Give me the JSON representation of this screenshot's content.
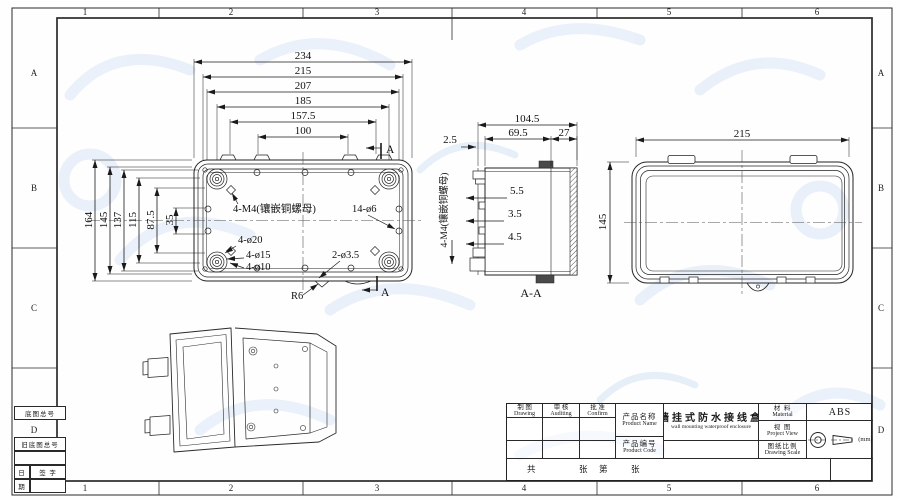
{
  "sheet": {
    "grid_cols": [
      "1",
      "2",
      "3",
      "4",
      "5",
      "6"
    ],
    "grid_rows": [
      "A",
      "B",
      "C",
      "D"
    ]
  },
  "margin_block": {
    "base_no": "底图总号",
    "old_base_no": "旧底图总号",
    "date_top": "日",
    "date_bottom": "期",
    "signature": "签  字"
  },
  "views": {
    "back": {
      "h_dims": [
        "234",
        "215",
        "207",
        "185",
        "157.5",
        "100"
      ],
      "v_dims": [
        "164",
        "145",
        "137",
        "115",
        "87.5",
        "35"
      ],
      "ann_insert": "4-M4(镶嵌铜螺母)",
      "ann_holes": "14-ø6",
      "ann_d20": "4-ø20",
      "ann_d15": "4-ø15",
      "ann_d10": "4-ø10",
      "ann_d35": "2-ø3.5",
      "ann_r6": "R6",
      "section_letter": "A"
    },
    "section": {
      "label": "A-A",
      "dim_total": "104.5",
      "dim_left": "69.5",
      "dim_right": "27",
      "dim_flange": "2.5",
      "dim_s1": "5.5",
      "dim_s2": "3.5",
      "dim_s3": "4.5",
      "ann_insert": "4-M4(镶嵌铜螺母)"
    },
    "lid": {
      "dim_width": "215",
      "dim_height": "145"
    }
  },
  "title_block": {
    "drawing_zh": "制 图",
    "drawing_en": "Drawing",
    "auditing_zh": "审 核",
    "auditing_en": "Auditing",
    "confirm_zh": "批 准",
    "confirm_en": "Confirm",
    "product_name_zh": "产品名称",
    "product_name_en": "Product Name",
    "product_name_value_zh": "墙挂式防水接线盒",
    "product_name_value_en": "wall mounting waterproof enclosure",
    "product_code_zh": "产品编号",
    "product_code_en": "Product Code",
    "material_zh": "材 料",
    "material_en": "Material",
    "material_value": "ABS",
    "view_zh": "视 图",
    "view_en": "Project View",
    "scale_zh": "图纸比例",
    "scale_en": "Drawing Scale",
    "unit": "(mm)",
    "sheet_char_1": "共",
    "sheet_char_2": "张",
    "sheet_char_3": "第",
    "sheet_char_4": "张"
  }
}
